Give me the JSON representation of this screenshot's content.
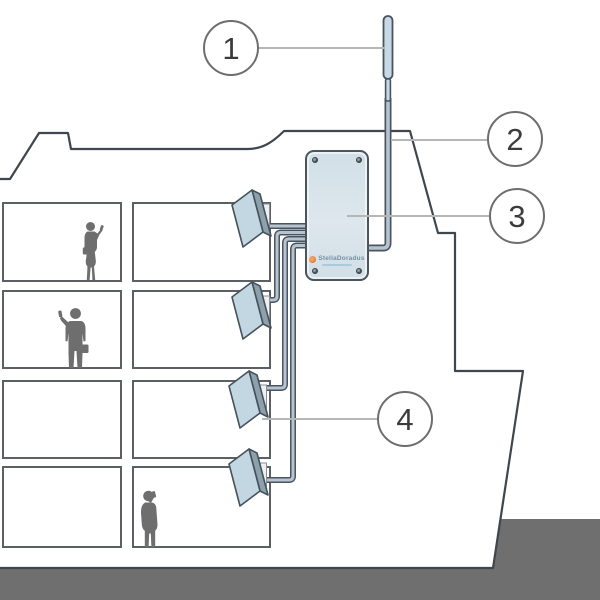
{
  "callouts": [
    {
      "number": "1"
    },
    {
      "number": "2"
    },
    {
      "number": "3"
    },
    {
      "number": "4"
    }
  ],
  "amplifier": {
    "brand": "StellaDoradus"
  },
  "scene": {
    "deck_count": 4,
    "indoor_antenna_count": 4,
    "people_count": 3
  },
  "colors": {
    "outline_dark": "#3f464d",
    "room_border": "#5c6065",
    "panel_face_blue": "#c3d7e3",
    "panel_side_blue": "#8da1ad",
    "cable_fill": "#b5c4d0",
    "cable_outline": "#4a545e",
    "box_fill": "#d8e3ea",
    "dock_gray": "#6f6f6f",
    "silhouette_gray": "#6e6e6e",
    "leader_gray": "#b6b6b6",
    "callout_border": "#6d6d6d",
    "logo_orange": "#e0762a",
    "brand_blue": "#7492a4"
  }
}
